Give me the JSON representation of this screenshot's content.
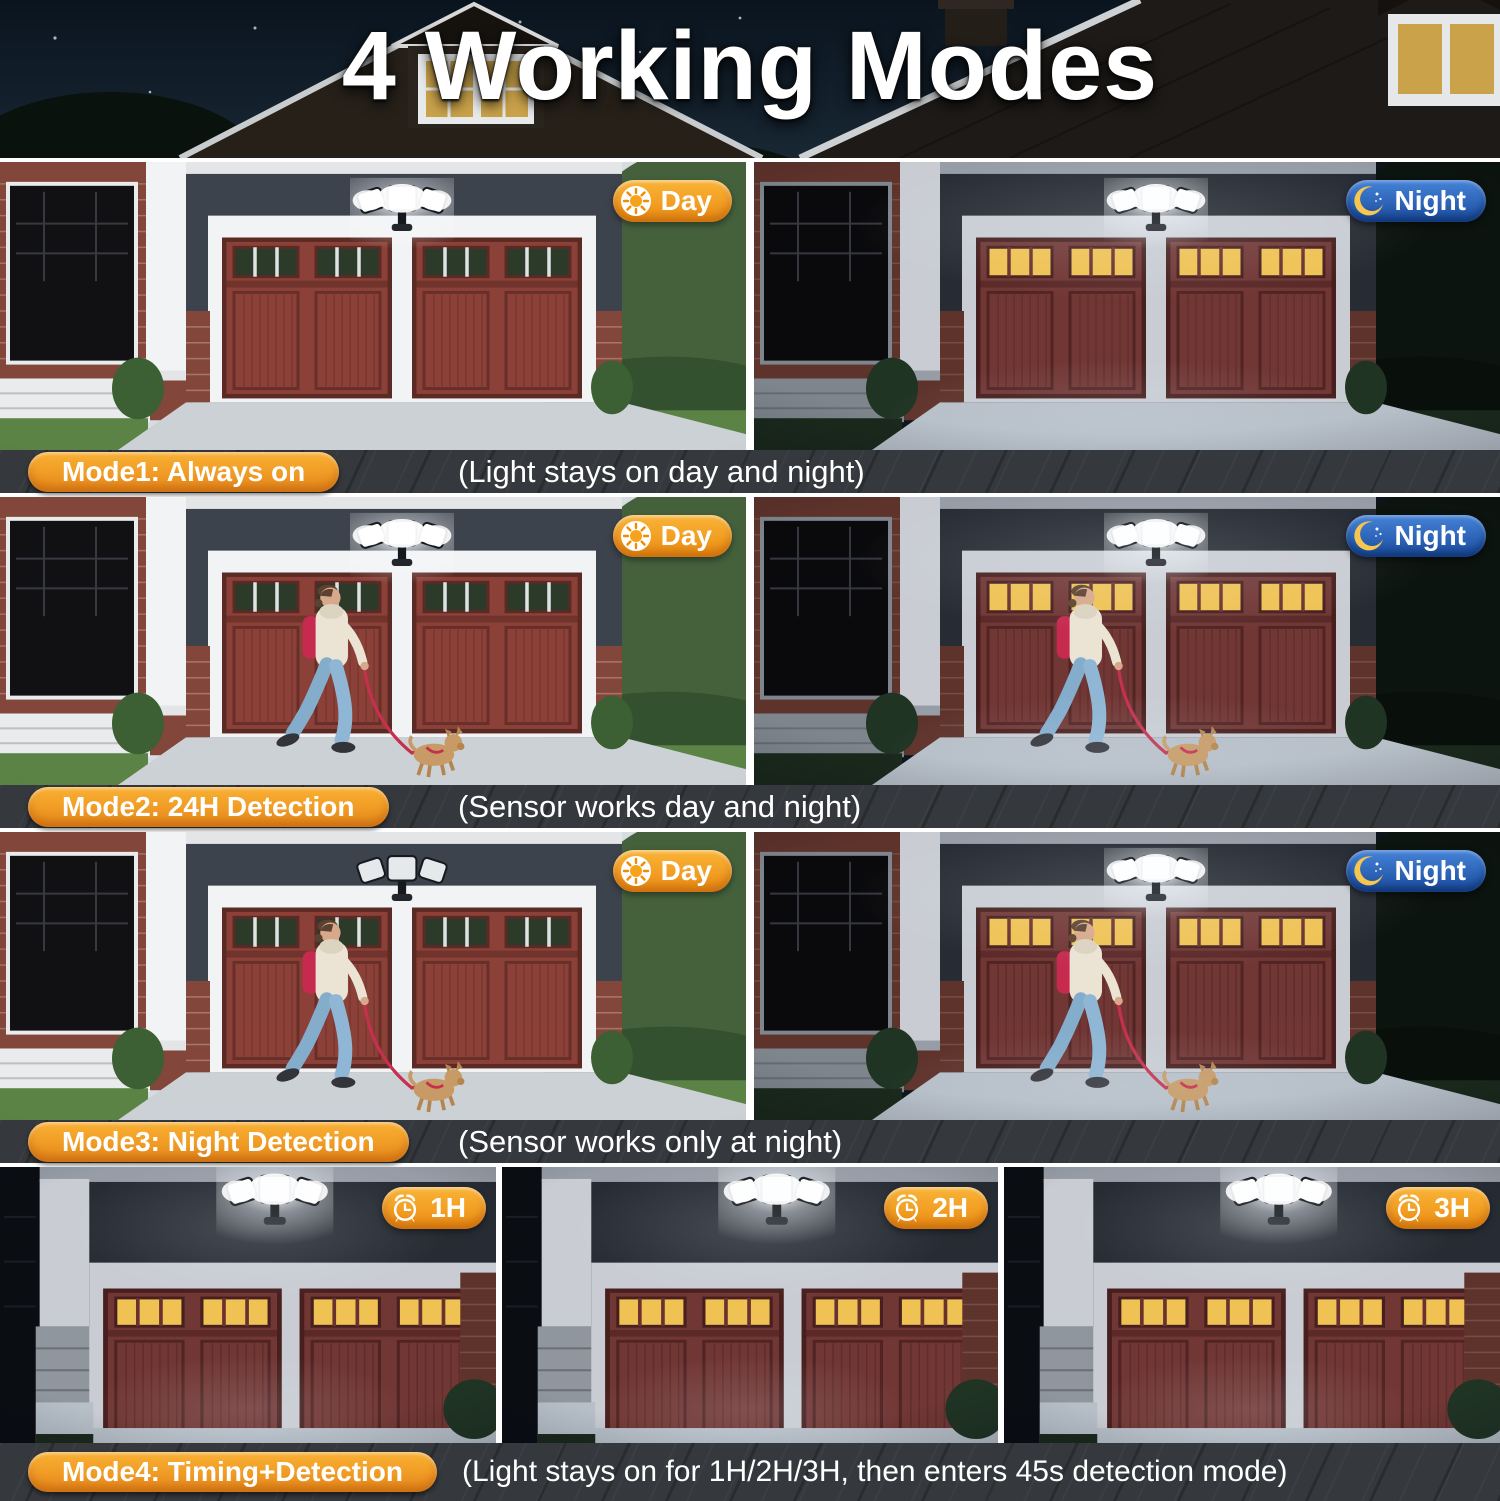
{
  "title": "4 Working Modes",
  "rows": [
    {
      "mode_label": "Mode1: Always on",
      "description": "(Light stays on day and night)",
      "panels": [
        {
          "badge_label": "Day",
          "badge_icon": "sun-icon",
          "time": "day",
          "light": "on"
        },
        {
          "badge_label": "Night",
          "badge_icon": "moon-icon",
          "time": "night",
          "light": "on"
        }
      ]
    },
    {
      "mode_label": "Mode2: 24H Detection",
      "description": "(Sensor works day and night)",
      "panels": [
        {
          "badge_label": "Day",
          "badge_icon": "sun-icon",
          "time": "day",
          "light": "on",
          "motion": "person walking dog"
        },
        {
          "badge_label": "Night",
          "badge_icon": "moon-icon",
          "time": "night",
          "light": "on",
          "motion": "person walking dog"
        }
      ]
    },
    {
      "mode_label": "Mode3: Night Detection",
      "description": "(Sensor works only at night)",
      "panels": [
        {
          "badge_label": "Day",
          "badge_icon": "sun-icon",
          "time": "day",
          "light": "off",
          "motion": "person walking dog"
        },
        {
          "badge_label": "Night",
          "badge_icon": "moon-icon",
          "time": "night",
          "light": "on",
          "motion": "person walking dog"
        }
      ]
    },
    {
      "mode_label": "Mode4: Timing+Detection",
      "description": "(Light stays on for 1H/2H/3H, then enters 45s detection mode)",
      "panels": [
        {
          "badge_label": "1H",
          "badge_icon": "alarm-clock-icon",
          "time": "night",
          "light": "on"
        },
        {
          "badge_label": "2H",
          "badge_icon": "alarm-clock-icon",
          "time": "night",
          "light": "on"
        },
        {
          "badge_label": "3H",
          "badge_icon": "alarm-clock-icon",
          "time": "night",
          "light": "on"
        }
      ]
    }
  ],
  "colors": {
    "accent_orange": "#f09a1f",
    "badge_blue": "#2a62b8",
    "window_glow": "#efc253",
    "caption_strip": "#35383c",
    "title_white": "#ffffff"
  }
}
